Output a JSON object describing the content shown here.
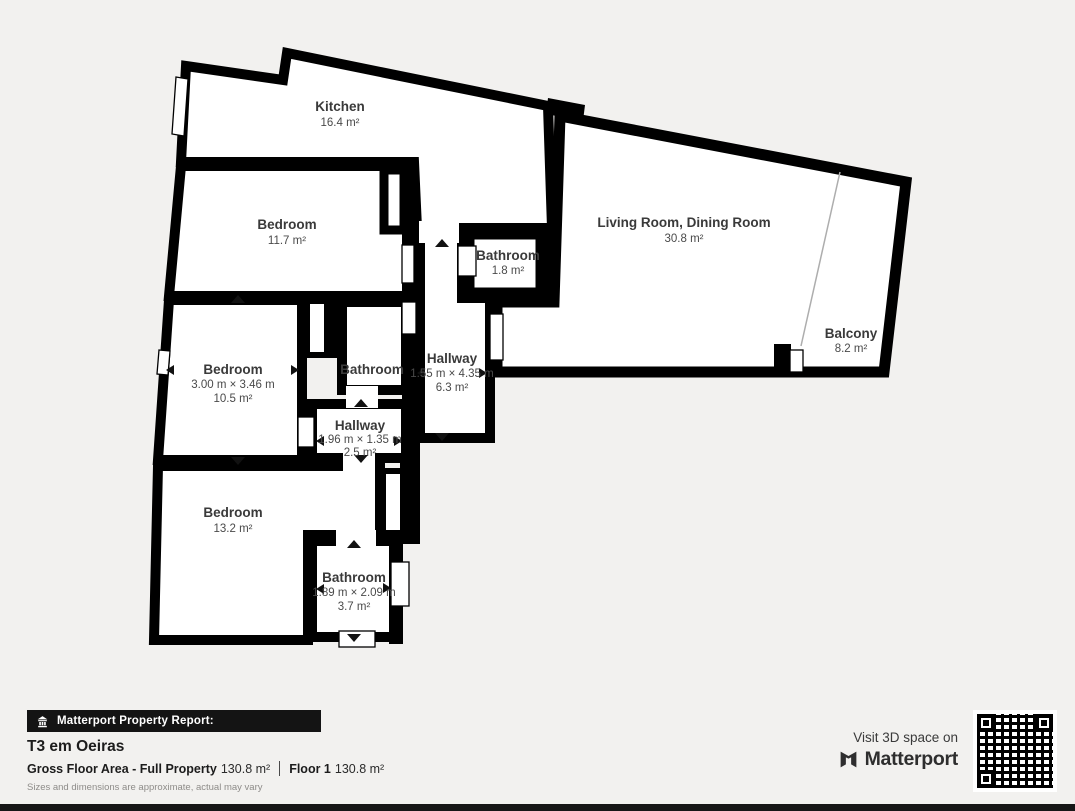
{
  "plan": {
    "rooms": [
      {
        "id": "kitchen",
        "name": "Kitchen",
        "area": "16.4 m²"
      },
      {
        "id": "bedroom-top",
        "name": "Bedroom",
        "area": "11.7 m²"
      },
      {
        "id": "bedroom-mid",
        "name": "Bedroom",
        "dims": "3.00 m × 3.46 m",
        "area": "10.5 m²"
      },
      {
        "id": "bedroom-bottom",
        "name": "Bedroom",
        "area": "13.2 m²"
      },
      {
        "id": "bathroom-top",
        "name": "Bathroom",
        "area": "1.8 m²"
      },
      {
        "id": "bathroom-mid",
        "name": "Bathroom"
      },
      {
        "id": "hallway-main",
        "name": "Hallway",
        "dims": "1.55 m × 4.35 m",
        "area": "6.3 m²"
      },
      {
        "id": "hallway-small",
        "name": "Hallway",
        "dims": "1.96 m × 1.35 m",
        "area": "2.5 m²"
      },
      {
        "id": "bathroom-bottom",
        "name": "Bathroom",
        "dims": "1.89 m × 2.09 m",
        "area": "3.7 m²"
      },
      {
        "id": "living",
        "name": "Living Room, Dining Room",
        "area": "30.8 m²"
      },
      {
        "id": "balcony",
        "name": "Balcony",
        "area": "8.2 m²"
      }
    ]
  },
  "footer": {
    "report_label": "Matterport Property Report:",
    "property_name": "T3 em Oeiras",
    "gfa_label": "Gross Floor Area - Full Property",
    "gfa_value": "130.8 m²",
    "floor_label": "Floor 1",
    "floor_value": "130.8 m²",
    "disclaimer": "Sizes and dimensions are approximate, actual may vary"
  },
  "cta": {
    "visit_label": "Visit 3D space on",
    "brand": "Matterport"
  },
  "colors": {
    "wall": "#000000",
    "floor": "#ffffff",
    "background": "#f2f1ef",
    "bar": "#141414",
    "text": "#3a3a3a"
  }
}
